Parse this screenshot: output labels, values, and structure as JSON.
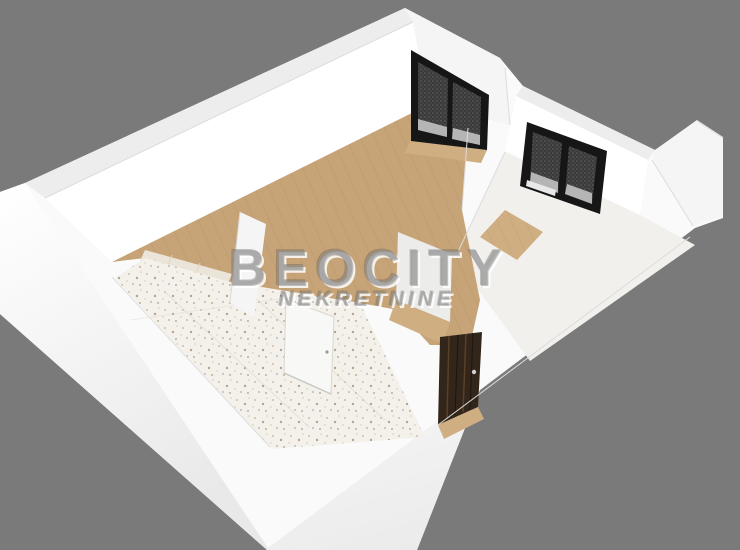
{
  "watermark": {
    "brand": "BEOCITY",
    "subtitle": "NEKRETNINE"
  },
  "scene": {
    "type": "3d-floor-plan-render",
    "rooms": [
      "main-room-wood-floor",
      "tiled-room-terrazzo",
      "right-room",
      "entry-hall"
    ],
    "openings": [
      "balcony-door",
      "window",
      "entry-door",
      "interior-white-door",
      "partition-doorway"
    ]
  },
  "colors": {
    "background": "#7a7a7a",
    "shell_white": "#fafafa",
    "wall_top": "#ededed",
    "wall_inner_bright": "#ffffff",
    "wall_soft": "#f5f5f5",
    "ext_grad_top": "#ffffff",
    "ext_grad_end": "#e9e9e9",
    "wood": "#c7a478",
    "wood_line": "#ad8a5c",
    "wood_light": "#cfae82",
    "tile_base": "#f4f1eb",
    "tile_kitchen": "#ebe4d9",
    "grout": "#ddd4c6",
    "frame_black": "#161616",
    "glass_dark": "#3b3b3b",
    "glass_light": "#b5b5b5",
    "window_sill": "#e8e8e8",
    "door_brown": "#32251a",
    "door_grain": "#5c4026",
    "door_grain_dark": "#1f150e",
    "white_door": "#f8f8f6",
    "white_door_edge": "#d8d8d2",
    "edge_line": "#dcdcdc",
    "floor_pale": "#f1f0ed",
    "watermark_body": "rgba(150,150,150,0.55)",
    "watermark_light": "rgba(255,255,255,0.85)",
    "watermark_dark": "rgba(70,70,70,0.30)"
  }
}
